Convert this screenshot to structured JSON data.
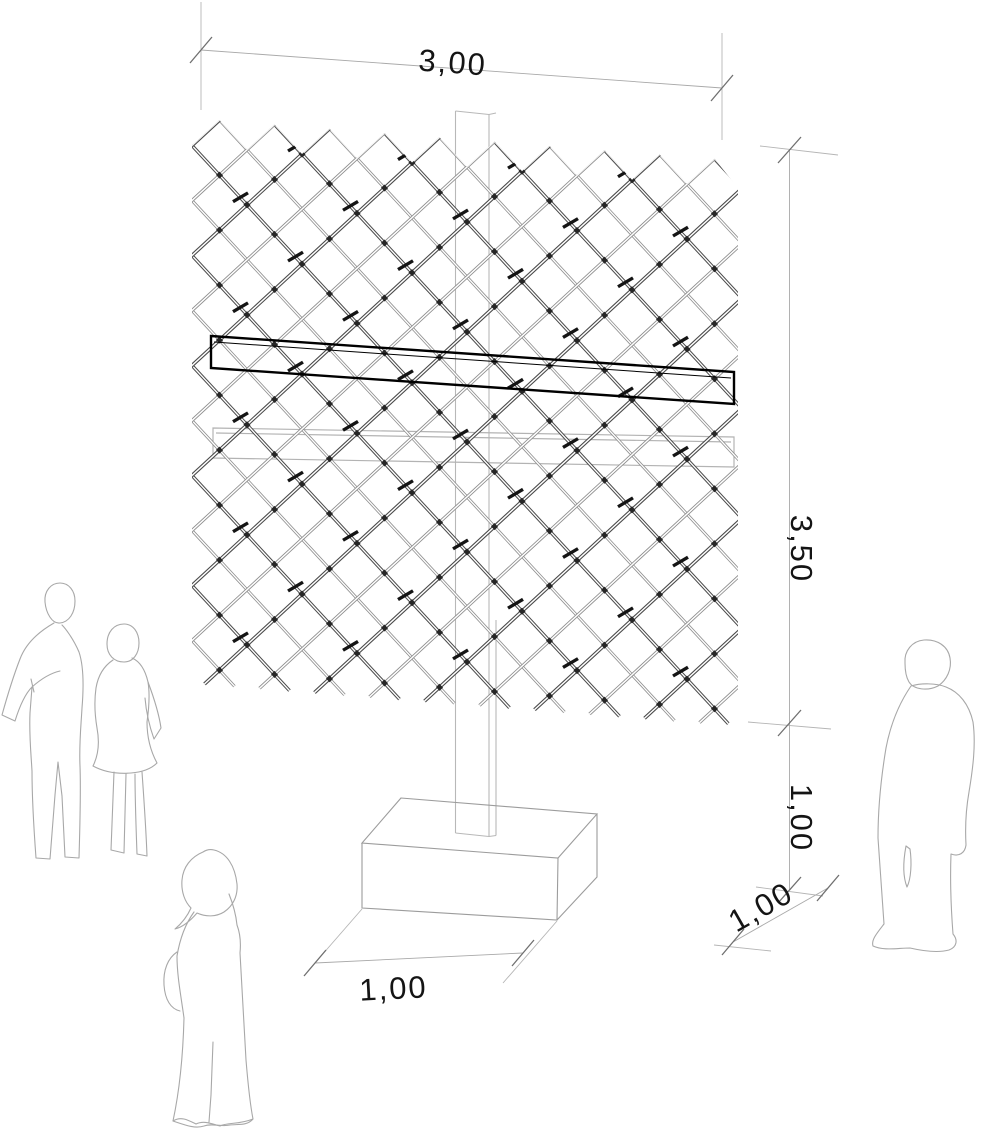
{
  "drawing": {
    "title": "lattice-screen-axonometric",
    "subject": "diagonal lattice screen panel mounted on a post with concrete base and scale figures",
    "dimensions": {
      "panel_width": "3,00",
      "panel_height": "3,50",
      "post_height": "1,00",
      "base_depth": "1,00",
      "base_width": "1,00"
    },
    "figures": {
      "left": "standing couple outline",
      "center": "walking woman outline",
      "right": "standing man outline"
    },
    "colors": {
      "background": "#ffffff",
      "rod_dark": "#4a4a4a",
      "rod_light": "#8f8f8f",
      "rod_core": "#ffffff",
      "node": "#262626",
      "connector_tick": "#141414",
      "beam_dark": "#000000",
      "beam_light": "#b3b3b3",
      "post": "#b8b8b8",
      "base_outline": "#9c9c9c",
      "dimension_line": "#a9a9a9",
      "extension_line": "#b5b5b5",
      "tick": "#6f6f6f",
      "dimension_text": "#141414",
      "figure_outline": "#a8a8a8"
    }
  }
}
